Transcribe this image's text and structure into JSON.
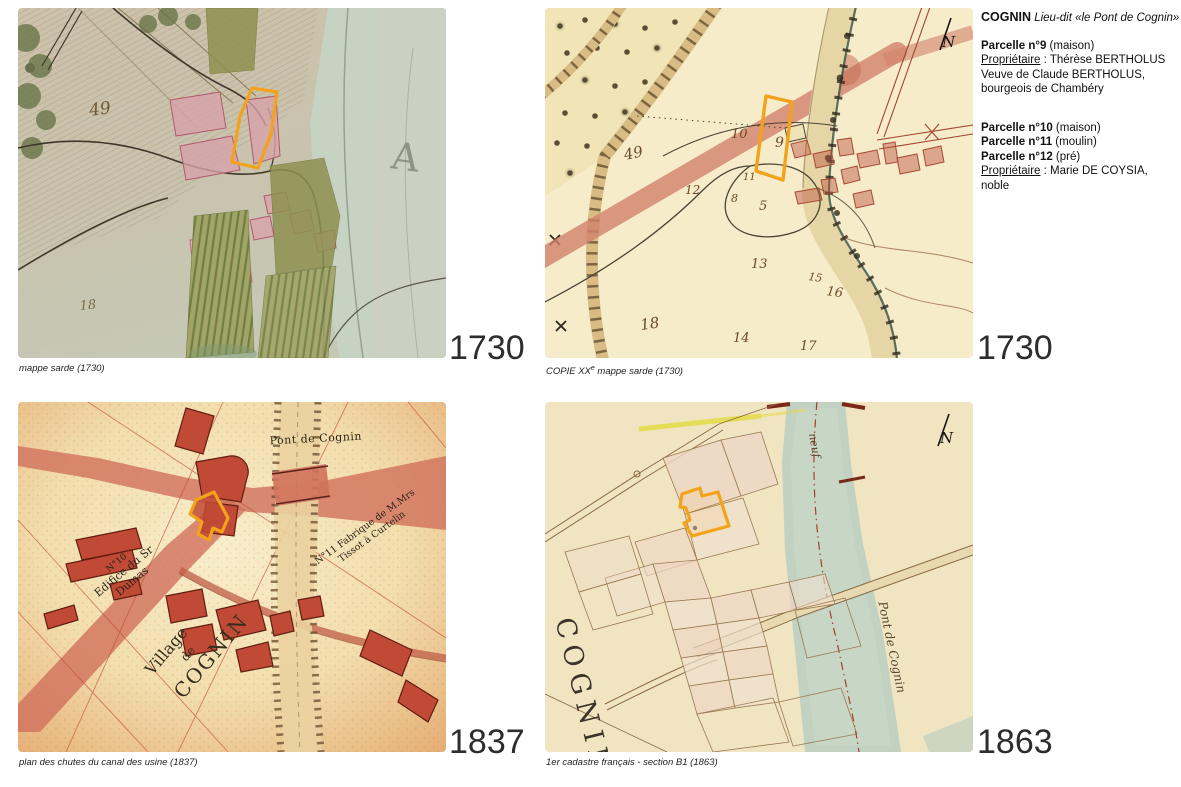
{
  "colors": {
    "highlight": "#F2A31B"
  },
  "info": {
    "title": "COGNIN",
    "subtitle": " Lieu-dit «le Pont de Cognin»",
    "b1_parcel": "Parcelle n°9",
    "b1_type": " (maison)",
    "b1_owner_label": "Propriétaire",
    "b1_owner_rest": " : Thérèse BERTHOLUS",
    "b1_line2": "Veuve de Claude BERTHOLUS,",
    "b1_line3": "bourgeois de Chambéry",
    "b2_parcels": [
      {
        "name": "Parcelle n°10",
        "type": " (maison)"
      },
      {
        "name": "Parcelle n°11",
        "type": " (moulin)"
      },
      {
        "name": "Parcelle n°12",
        "type": " (pré)"
      }
    ],
    "b2_owner_label": "Propriétaire",
    "b2_owner_rest": " : Marie DE COYSIA, noble"
  },
  "panels": {
    "sarde": {
      "caption": "mappe sarde (1730)",
      "year": "1730",
      "labels": {
        "n49": "49",
        "n18": "18",
        "river_letter": "A"
      }
    },
    "copie": {
      "caption_pre": "COPIE XX",
      "caption_sup": "e",
      "caption_post": " mappe sarde (1730)",
      "year": "1730",
      "north": "N",
      "numbers": {
        "n10": "10",
        "n9": "9",
        "n49": "49",
        "n11": "11",
        "n12": "12",
        "n8": "8",
        "n5": "5",
        "n13": "13",
        "n15": "15",
        "n16": "16",
        "n18": "18",
        "n14": "14",
        "n17": "17"
      }
    },
    "plan": {
      "caption": "plan des chutes du canal des usine (1837)",
      "year": "1837",
      "labels": {
        "bridge": "Pont de Cognin",
        "edifice_no": "N°10",
        "edifice_l1": "Edifice du Sr",
        "edifice_l2": "Dumas",
        "fabrique_l1": "N°11 Fabrique de M.Mrs",
        "fabrique_l2": "Tissot à Curtelin",
        "village_l1": "Village",
        "village_l2": "de",
        "village_l3": "COGNIN"
      }
    },
    "cadastre": {
      "caption": "1er cadastre français - section B1 (1863)",
      "year": "1863",
      "north": "N",
      "labels": {
        "town": "COGNIN",
        "bridge": "Pont de Cognin",
        "canal": "neuf"
      }
    }
  }
}
